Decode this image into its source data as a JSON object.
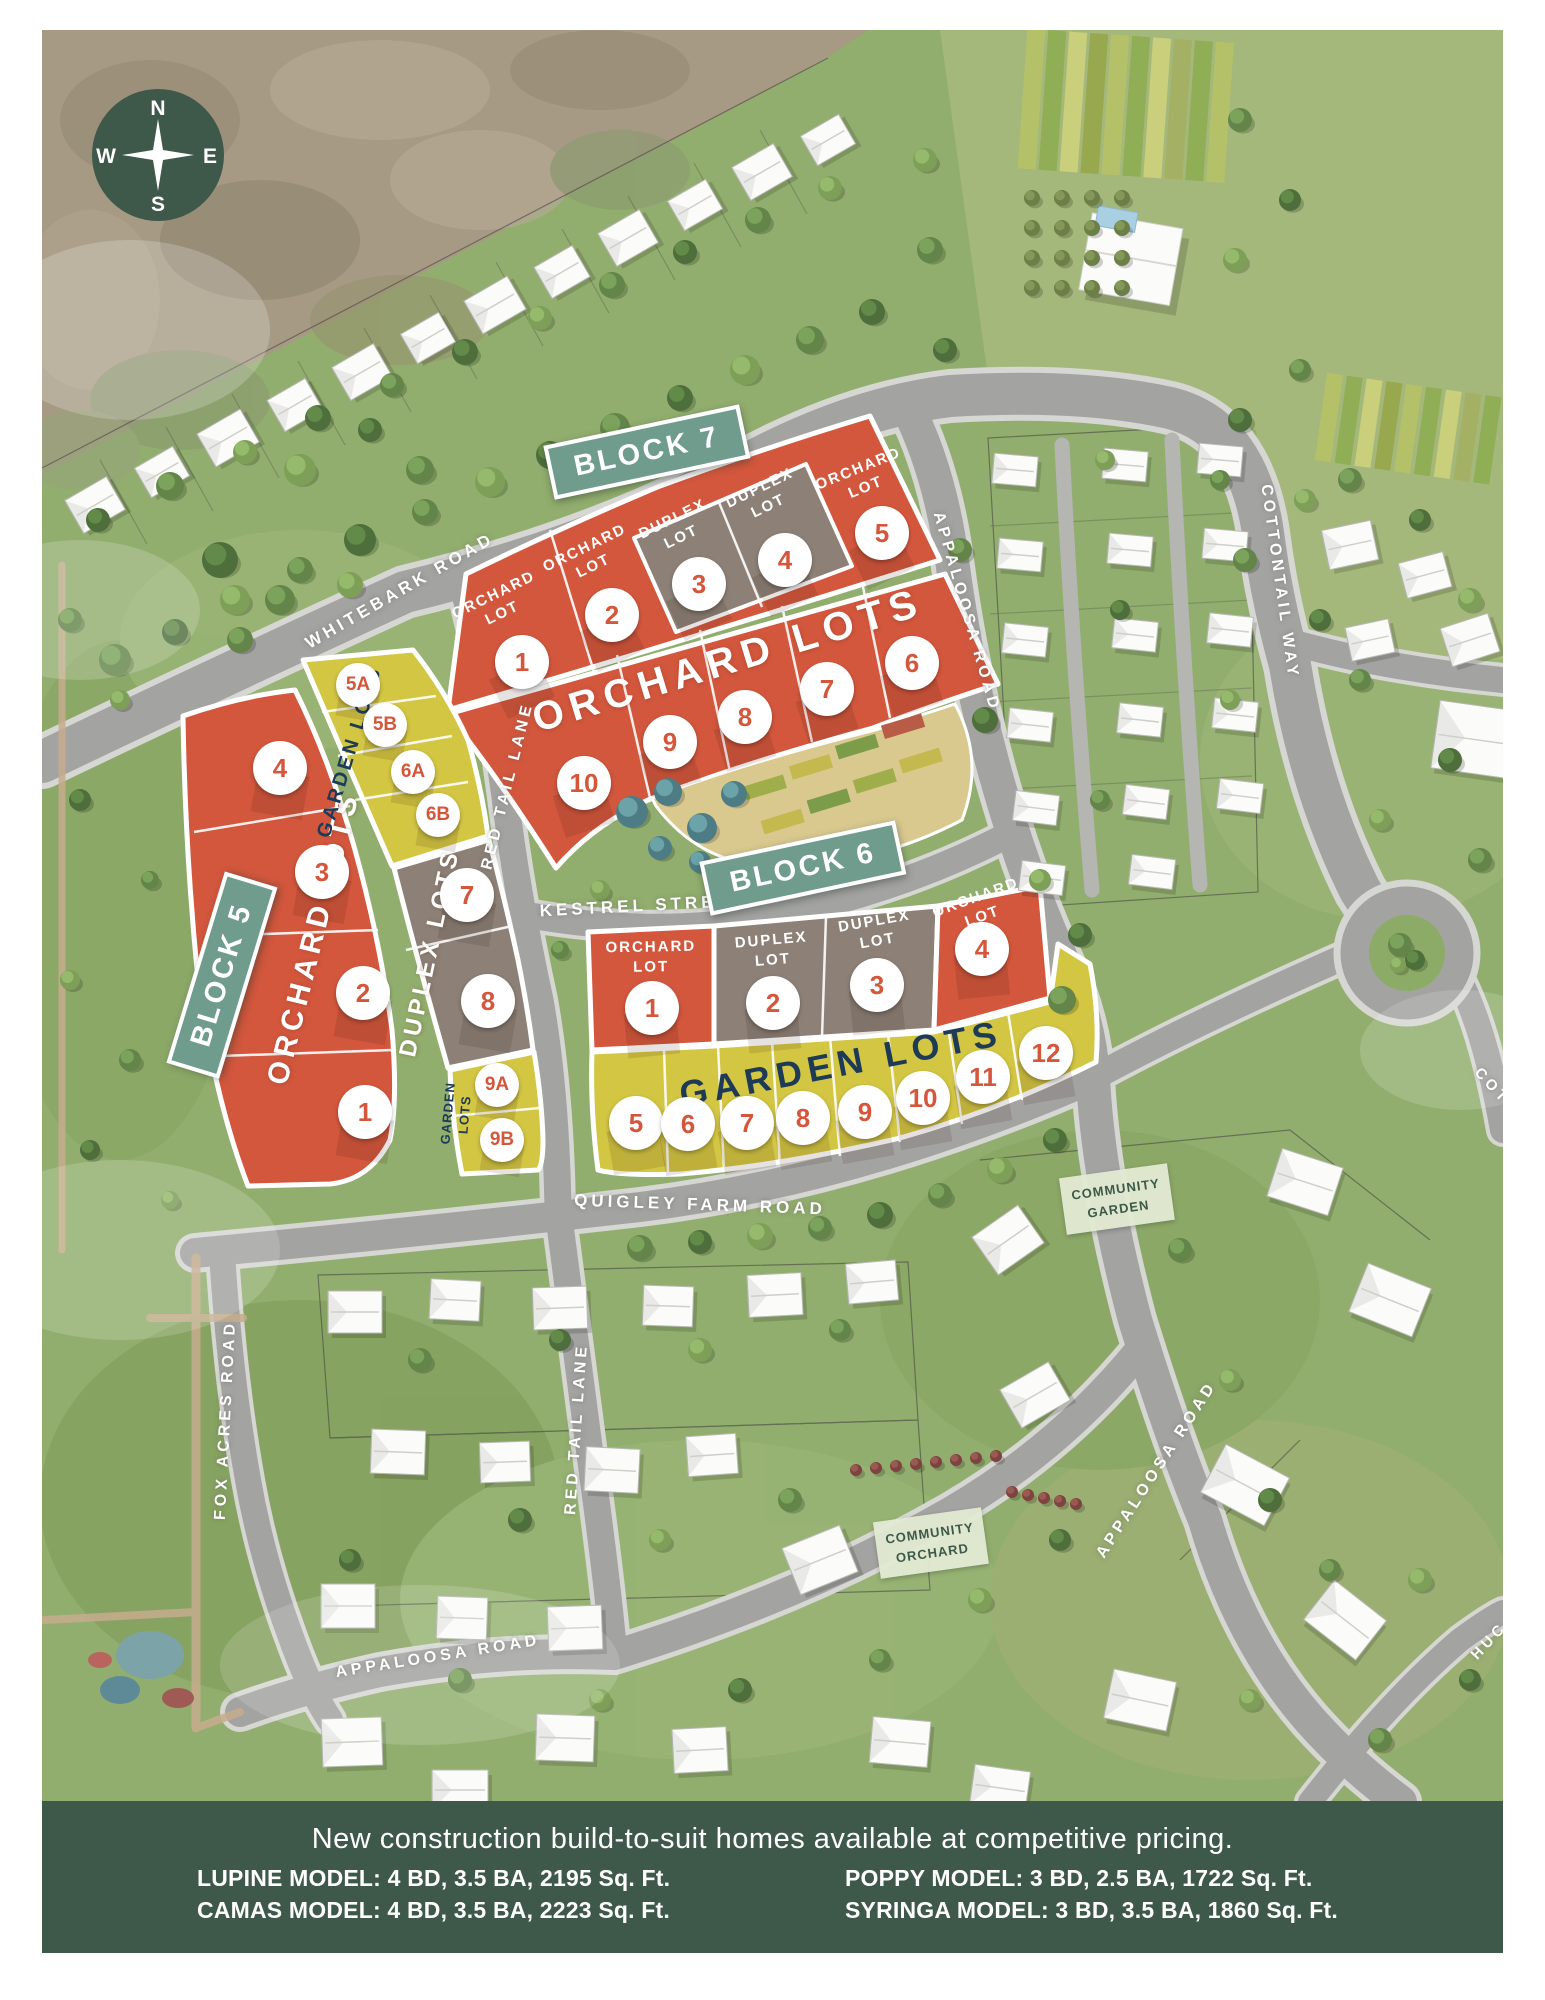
{
  "compass": {
    "n": "N",
    "e": "E",
    "s": "S",
    "w": "W"
  },
  "colors": {
    "orchard_lot": "#d3573d",
    "garden_lot": "#d3c643",
    "duplex_lot": "#8d8177",
    "block_sign": "#6f9c8d",
    "footer": "#3e5849",
    "number": "#d4573c",
    "navy": "#1d3a56",
    "scrub": "#a79a84",
    "grass": "#92ae6e",
    "road": "#a3a3a1"
  },
  "block_signs": [
    {
      "id": "block-5-sign",
      "label": "BLOCK 5",
      "x": 222,
      "y": 975,
      "rot": -73
    },
    {
      "id": "block-6-sign",
      "label": "BLOCK 6",
      "x": 803,
      "y": 868,
      "rot": -12
    },
    {
      "id": "block-7-sign",
      "label": "BLOCK 7",
      "x": 647,
      "y": 452,
      "rot": -12
    }
  ],
  "area_signs": [
    {
      "id": "community-garden-sign",
      "line1": "COMMUNITY",
      "line2": "GARDEN",
      "x": 1117,
      "y": 1199,
      "rot": -8
    },
    {
      "id": "community-orchard-sign",
      "line1": "COMMUNITY",
      "line2": "ORCHARD",
      "x": 931,
      "y": 1543,
      "rot": -8
    }
  ],
  "road_labels": [
    {
      "id": "whitebark-road-label",
      "text": "WHITEBARK ROAD",
      "x": 400,
      "y": 591,
      "rot": -30,
      "size": 17
    },
    {
      "id": "cottontail-way-label",
      "text": "COTTONTAIL WAY",
      "x": 1279,
      "y": 582,
      "rot": 82,
      "size": 16
    },
    {
      "id": "appaloosa-road-n-label",
      "text": "APPALOOSA ROAD",
      "x": 966,
      "y": 612,
      "rot": 74,
      "size": 16
    },
    {
      "id": "kestrel-street-label",
      "text": "KESTREL STREET",
      "x": 643,
      "y": 906,
      "rot": -3,
      "size": 17
    },
    {
      "id": "quigley-farm-road-label",
      "text": "QUIGLEY FARM ROAD",
      "x": 700,
      "y": 1205,
      "rot": 2,
      "size": 17
    },
    {
      "id": "fox-acres-road-label",
      "text": "FOX ACRES ROAD",
      "x": 226,
      "y": 1420,
      "rot": -87,
      "size": 16
    },
    {
      "id": "red-tail-lane-n-label",
      "text": "RED TAIL LANE",
      "x": 508,
      "y": 786,
      "rot": -76,
      "size": 16
    },
    {
      "id": "red-tail-lane-s-label",
      "text": "RED TAIL LANE",
      "x": 577,
      "y": 1429,
      "rot": -86,
      "size": 16
    },
    {
      "id": "appaloosa-road-se-label",
      "text": "APPALOOSA ROAD",
      "x": 1157,
      "y": 1470,
      "rot": -57,
      "size": 16
    },
    {
      "id": "appaloosa-road-sw-label",
      "text": "APPALOOSA ROAD",
      "x": 438,
      "y": 1657,
      "rot": -9,
      "size": 16
    },
    {
      "id": "cottontail-edge-label",
      "text": "COT",
      "x": 1492,
      "y": 1086,
      "rot": 47,
      "size": 15
    },
    {
      "id": "huckleberry-edge-label",
      "text": "HUC",
      "x": 1489,
      "y": 1641,
      "rot": -47,
      "size": 15
    }
  ],
  "lot_labels": [
    {
      "id": "b7-orchard-lot-1-label",
      "line1": "ORCHARD",
      "line2": "LOT",
      "x": 498,
      "y": 604,
      "rot": -26
    },
    {
      "id": "b7-orchard-lot-2-label",
      "line1": "ORCHARD",
      "line2": "LOT",
      "x": 589,
      "y": 557,
      "rot": -26
    },
    {
      "id": "b7-duplex-lot-3-label",
      "line1": "DUPLEX",
      "line2": "LOT",
      "x": 677,
      "y": 528,
      "rot": -26
    },
    {
      "id": "b7-duplex-lot-4-label",
      "line1": "DUPLEX",
      "line2": "LOT",
      "x": 764,
      "y": 497,
      "rot": -26
    },
    {
      "id": "b7-orchard-lot-5-label",
      "line1": "ORCHARD",
      "line2": "LOT",
      "x": 862,
      "y": 478,
      "rot": -22
    },
    {
      "id": "b6-orchard-lot-1-label",
      "line1": "ORCHARD",
      "line2": "LOT",
      "x": 651,
      "y": 957,
      "rot": -1
    },
    {
      "id": "b6-duplex-lot-2-label",
      "line1": "DUPLEX",
      "line2": "LOT",
      "x": 772,
      "y": 950,
      "rot": -5
    },
    {
      "id": "b6-duplex-lot-3-label",
      "line1": "DUPLEX",
      "line2": "LOT",
      "x": 876,
      "y": 931,
      "rot": -10
    },
    {
      "id": "b6-orchard-lot-4-label",
      "line1": "ORCHARD",
      "line2": "LOT",
      "x": 979,
      "y": 907,
      "rot": -20
    },
    {
      "id": "b5-garden-lots-9-label",
      "line1": "GARDEN",
      "line2": "LOTS",
      "x": 457,
      "y": 1114,
      "rot": -85,
      "size": 13,
      "color": "#1d3a56"
    }
  ],
  "strip_titles": [
    {
      "id": "b7-orchard-lots-title",
      "text": "ORCHARD LOTS",
      "x": 728,
      "y": 661,
      "rot": -17,
      "size": 40,
      "color": "#ffffff",
      "ls": 7
    },
    {
      "id": "b6-garden-lots-title",
      "text": "GARDEN LOTS",
      "x": 841,
      "y": 1064,
      "rot": -11,
      "size": 36,
      "color": "#1d3a56",
      "ls": 6
    },
    {
      "id": "b5-orchard-lots-title",
      "text": "ORCHARD LOTS",
      "x": 314,
      "y": 938,
      "rot": -76,
      "size": 30,
      "color": "#ffffff",
      "ls": 5
    },
    {
      "id": "b5-garden-lots-title",
      "text": "GARDEN LOTS",
      "x": 350,
      "y": 752,
      "rot": -73,
      "size": 20,
      "color": "#1d3a56",
      "ls": 3
    },
    {
      "id": "b5-duplex-lots-title",
      "text": "DUPLEX LOTS",
      "x": 430,
      "y": 953,
      "rot": -78,
      "size": 24,
      "color": "#ffffff",
      "ls": 4
    }
  ],
  "lot_numbers": [
    {
      "id": "b7-1",
      "n": "1",
      "x": 522,
      "y": 662
    },
    {
      "id": "b7-2",
      "n": "2",
      "x": 612,
      "y": 615
    },
    {
      "id": "b7-3",
      "n": "3",
      "x": 699,
      "y": 584
    },
    {
      "id": "b7-4",
      "n": "4",
      "x": 785,
      "y": 560
    },
    {
      "id": "b7-5",
      "n": "5",
      "x": 882,
      "y": 533
    },
    {
      "id": "b7-6",
      "n": "6",
      "x": 912,
      "y": 663
    },
    {
      "id": "b7-7",
      "n": "7",
      "x": 827,
      "y": 689
    },
    {
      "id": "b7-8",
      "n": "8",
      "x": 745,
      "y": 717
    },
    {
      "id": "b7-9",
      "n": "9",
      "x": 670,
      "y": 742
    },
    {
      "id": "b7-10",
      "n": "10",
      "x": 584,
      "y": 783
    },
    {
      "id": "b6-1",
      "n": "1",
      "x": 652,
      "y": 1008
    },
    {
      "id": "b6-2",
      "n": "2",
      "x": 773,
      "y": 1003
    },
    {
      "id": "b6-3",
      "n": "3",
      "x": 877,
      "y": 985
    },
    {
      "id": "b6-4",
      "n": "4",
      "x": 982,
      "y": 949
    },
    {
      "id": "b6-5",
      "n": "5",
      "x": 636,
      "y": 1123
    },
    {
      "id": "b6-6",
      "n": "6",
      "x": 688,
      "y": 1124
    },
    {
      "id": "b6-7",
      "n": "7",
      "x": 747,
      "y": 1123
    },
    {
      "id": "b6-8",
      "n": "8",
      "x": 803,
      "y": 1118
    },
    {
      "id": "b6-9",
      "n": "9",
      "x": 865,
      "y": 1112
    },
    {
      "id": "b6-10",
      "n": "10",
      "x": 923,
      "y": 1098
    },
    {
      "id": "b6-11",
      "n": "11",
      "x": 983,
      "y": 1077
    },
    {
      "id": "b6-12",
      "n": "12",
      "x": 1046,
      "y": 1053
    },
    {
      "id": "b5-4",
      "n": "4",
      "x": 280,
      "y": 768
    },
    {
      "id": "b5-3",
      "n": "3",
      "x": 322,
      "y": 872
    },
    {
      "id": "b5-2",
      "n": "2",
      "x": 363,
      "y": 993
    },
    {
      "id": "b5-1",
      "n": "1",
      "x": 365,
      "y": 1112
    },
    {
      "id": "b5-5A",
      "n": "5A",
      "x": 358,
      "y": 685,
      "s": 1
    },
    {
      "id": "b5-5B",
      "n": "5B",
      "x": 385,
      "y": 725,
      "s": 1
    },
    {
      "id": "b5-6A",
      "n": "6A",
      "x": 413,
      "y": 772,
      "s": 1
    },
    {
      "id": "b5-6B",
      "n": "6B",
      "x": 438,
      "y": 815,
      "s": 1
    },
    {
      "id": "b5-7",
      "n": "7",
      "x": 467,
      "y": 895
    },
    {
      "id": "b5-8",
      "n": "8",
      "x": 488,
      "y": 1001
    },
    {
      "id": "b5-9A",
      "n": "9A",
      "x": 497,
      "y": 1085,
      "s": 1
    },
    {
      "id": "b5-9B",
      "n": "9B",
      "x": 502,
      "y": 1140,
      "s": 1
    }
  ],
  "footer": {
    "headline": "New construction build-to-suit homes available at competitive pricing.",
    "models": [
      {
        "id": "lupine-model",
        "text": "LUPINE MODEL: 4 BD, 3.5 BA, 2195 Sq. Ft."
      },
      {
        "id": "camas-model",
        "text": "CAMAS MODEL: 4 BD, 3.5 BA, 2223 Sq. Ft."
      },
      {
        "id": "poppy-model",
        "text": "POPPY MODEL: 3 BD, 2.5 BA, 1722 Sq. Ft."
      },
      {
        "id": "syringa-model",
        "text": "SYRINGA MODEL: 3 BD, 3.5 BA, 1860 Sq. Ft."
      }
    ]
  }
}
